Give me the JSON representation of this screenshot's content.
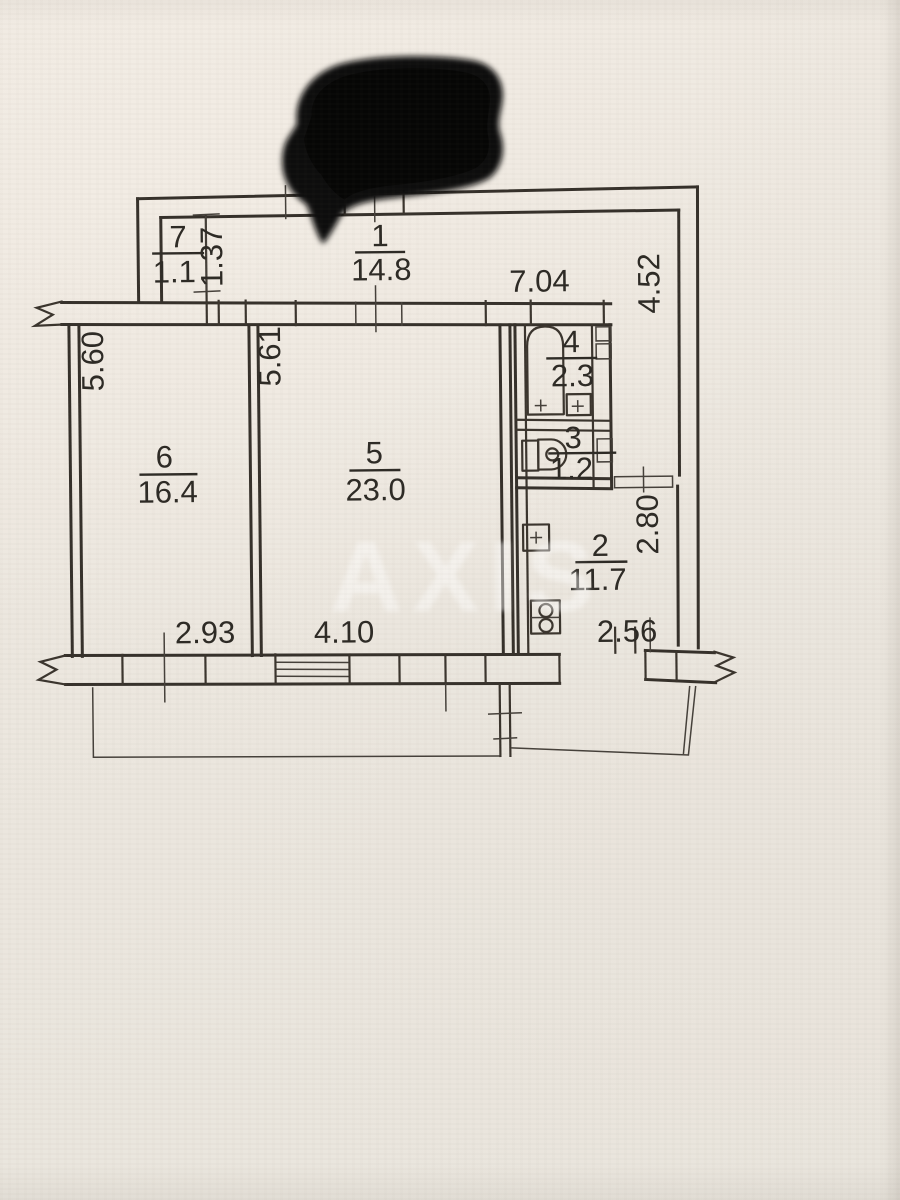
{
  "watermark": {
    "text": "AXIS"
  },
  "rooms": [
    {
      "id": "room-1",
      "label": "hallway",
      "number": "1",
      "area": "14.8"
    },
    {
      "id": "room-2",
      "label": "kitchen",
      "number": "2",
      "area": "11.7"
    },
    {
      "id": "room-3",
      "label": "toilet",
      "number": "3",
      "area": "1.2"
    },
    {
      "id": "room-4",
      "label": "bathroom",
      "number": "4",
      "area": "2.3"
    },
    {
      "id": "room-5",
      "label": "living-room",
      "number": "5",
      "area": "23.0"
    },
    {
      "id": "room-6",
      "label": "bedroom",
      "number": "6",
      "area": "16.4"
    },
    {
      "id": "room-7",
      "label": "closet",
      "number": "7",
      "area": "1.1"
    }
  ],
  "dimensions": {
    "closet_depth": "1.37",
    "hall_width": "7.04",
    "hall_depth": "4.52",
    "room6_depth": "5.60",
    "room5_depth": "5.61",
    "kitchen_depth": "2.80",
    "kitchen_width": "2.56",
    "room6_width": "2.93",
    "room5_width": "4.10"
  },
  "colors": {
    "paper": "#ece7df",
    "ink": "#35302a",
    "redaction": "#0b0a09",
    "watermark_text": "#ffffff"
  }
}
